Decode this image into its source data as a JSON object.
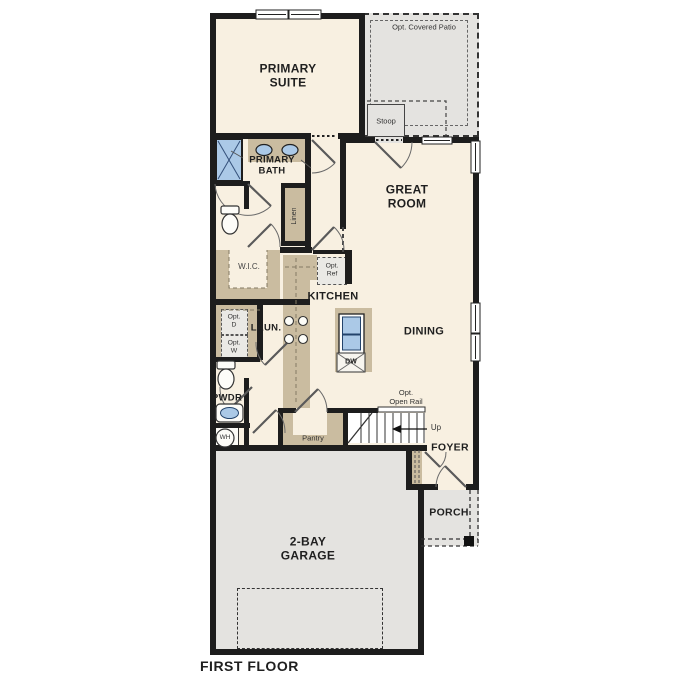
{
  "plan_title": "FIRST FLOOR",
  "colors": {
    "floor": "#f8f0e1",
    "outdoor": "#e4e3e0",
    "cabinet": "#cabca0",
    "fixture_blue": "#abc9e7",
    "wall": "#1d1d1d",
    "text": "#1f1f1f"
  },
  "rooms": {
    "primary_suite": "PRIMARY\nSUITE",
    "great_room": "GREAT\nROOM",
    "primary_bath": "PRIMARY\nBATH",
    "linen": "Linen",
    "wic": "W.I.C.",
    "kitchen": "KITCHEN",
    "dining": "DINING",
    "laundry": "LAUN.",
    "powder": "PWDR",
    "pantry": "Pantry",
    "foyer": "FOYER",
    "porch": "PORCH",
    "garage": "2-BAY\nGARAGE",
    "stoop": "Stoop",
    "covered_patio": "Opt. Covered Patio"
  },
  "features": {
    "opt_ref": "Opt.\nRef",
    "opt_dryer": "Opt.\nD",
    "opt_washer": "Opt.\nW",
    "opt_open_rail": "Opt.\nOpen Rail",
    "up": "Up",
    "dishwasher": "DW",
    "water_heater": "WH"
  }
}
